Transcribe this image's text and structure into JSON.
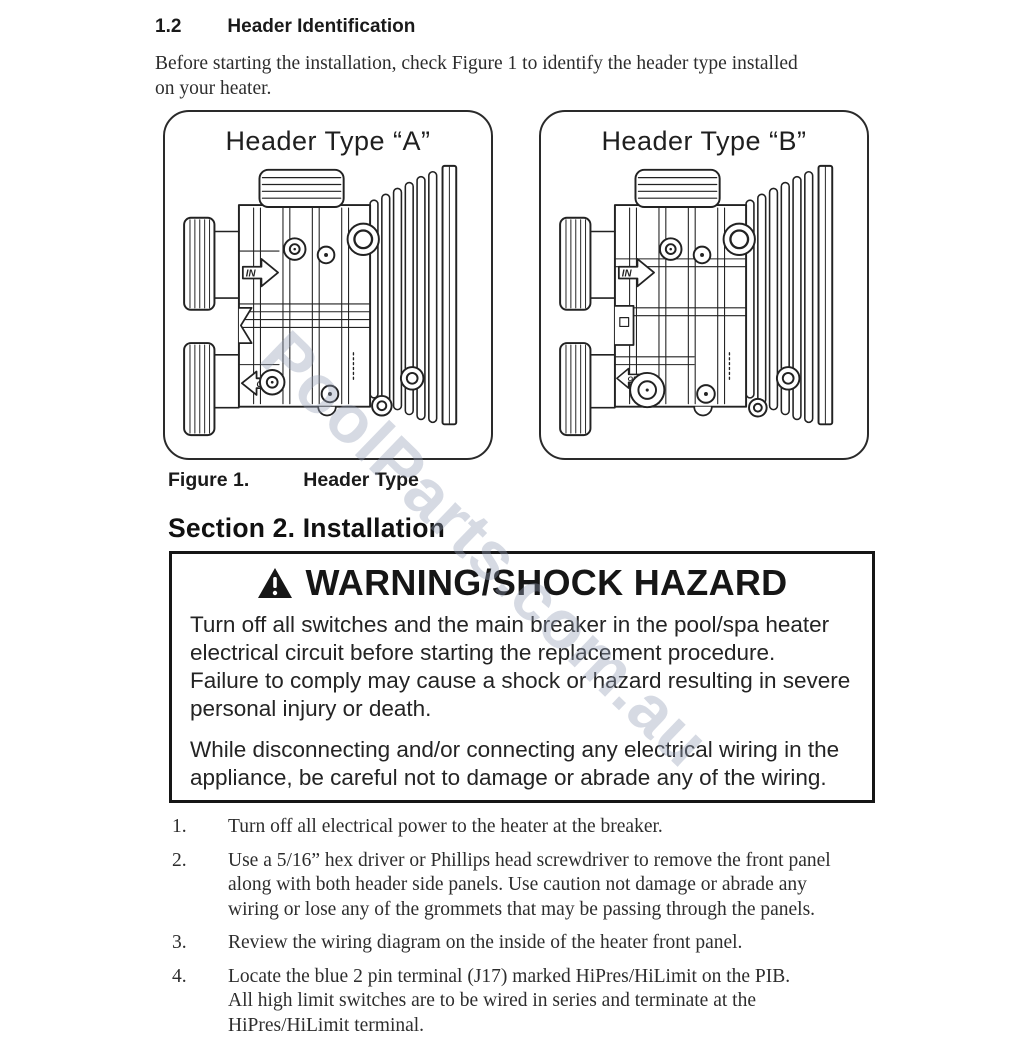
{
  "doc": {
    "section1": {
      "number": "1.2",
      "title": "Header Identification"
    },
    "intro": "Before starting the installation, check Figure 1 to identify the header type installed\non your heater.",
    "figures": [
      {
        "title": "Header Type “A”",
        "in_label": "IN",
        "out_label": "OUT"
      },
      {
        "title": "Header Type “B”",
        "in_label": "IN",
        "out_label": "OUT"
      }
    ],
    "caption": {
      "number": "Figure 1.",
      "title": "Header Type"
    },
    "section2": {
      "title": "Section 2. Installation"
    },
    "warning": {
      "title": "WARNING/SHOCK HAZARD",
      "para1": "Turn off all switches and the main breaker in the pool/spa heater\nelectrical circuit before starting the replacement procedure.\nFailure to comply may cause a shock or hazard resulting in severe\npersonal injury or death.",
      "para2": "While disconnecting and/or connecting any electrical wiring in the\nappliance, be careful not to damage or abrade any of the wiring."
    },
    "steps": [
      {
        "num": "1.",
        "text": "Turn off all electrical power to the heater at the breaker."
      },
      {
        "num": "2.",
        "text": "Use a 5/16” hex driver or Phillips head screwdriver to remove the front panel\nalong with both header side panels. Use caution not damage or abrade any\nwiring or lose any of the grommets that may be passing through the panels."
      },
      {
        "num": "3.",
        "text": "Review the wiring diagram on the inside of the heater front panel."
      },
      {
        "num": "4.",
        "text": "Locate the blue 2 pin terminal (J17) marked HiPres/HiLimit on the PIB.\nAll high limit switches are to be wired in series and terminate at the\nHiPres/HiLimit terminal."
      }
    ],
    "watermark": "PoolParts.com.au"
  }
}
